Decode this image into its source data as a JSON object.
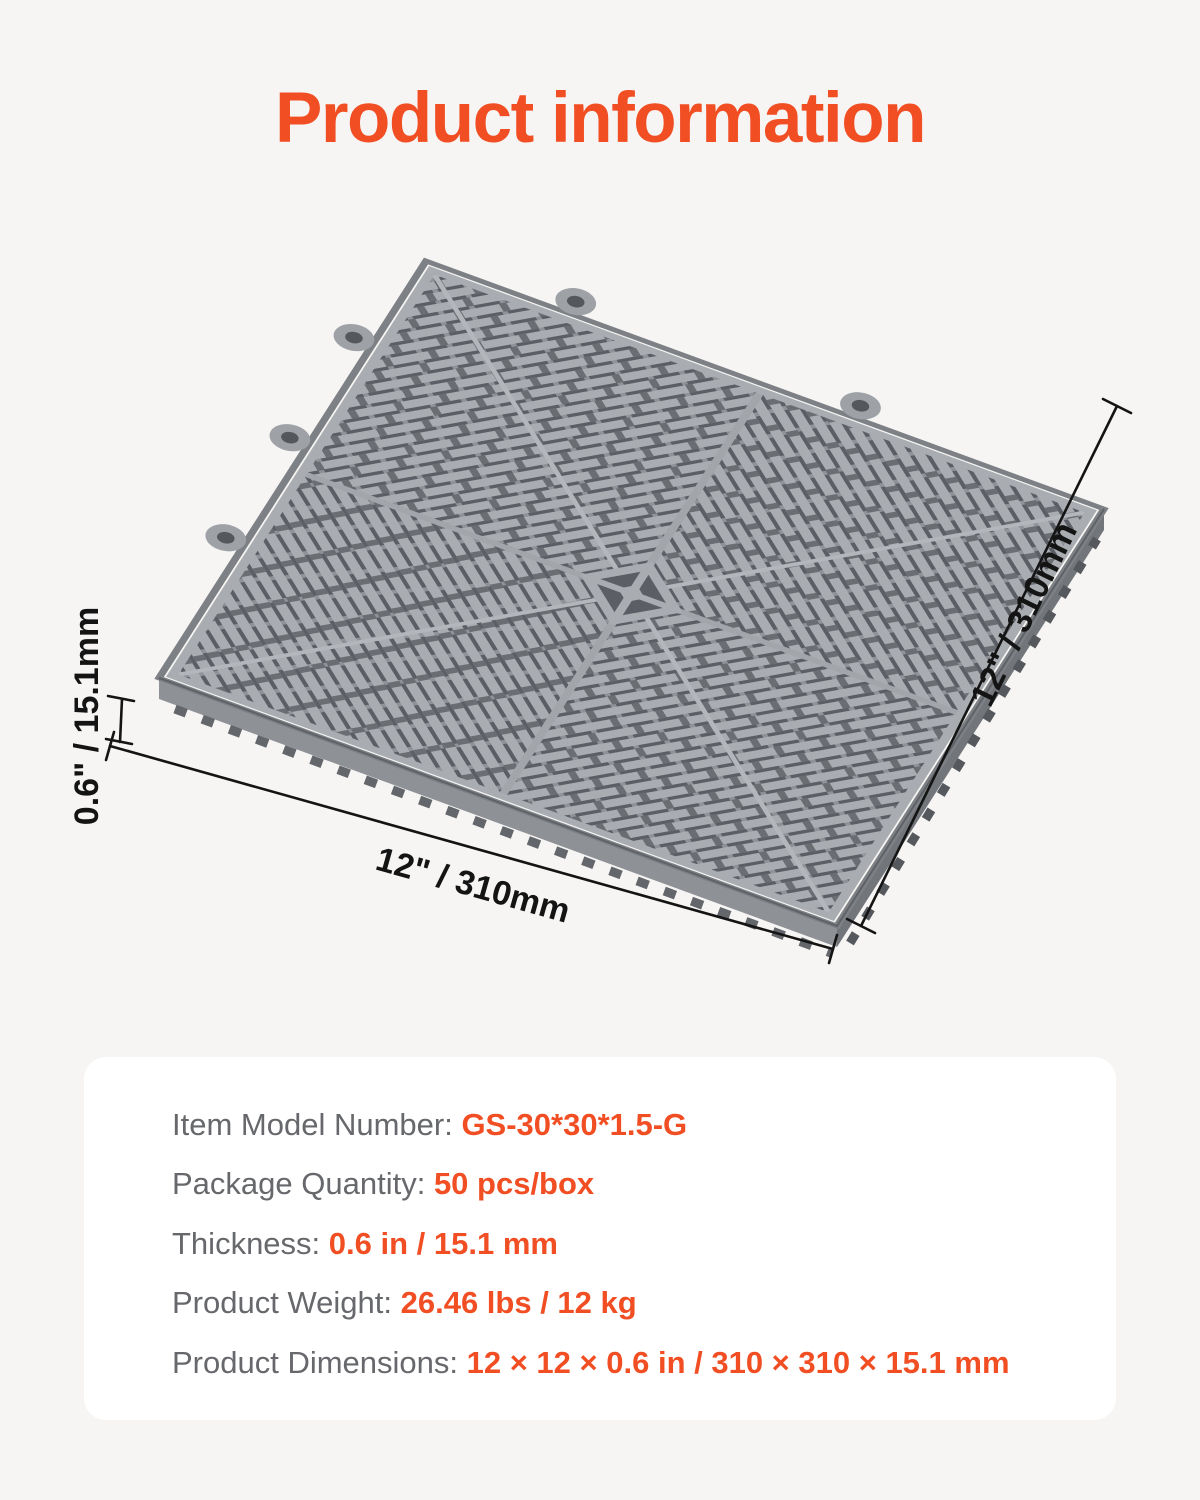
{
  "title": "Product information",
  "figure": {
    "dim_width_bottom": "12\" / 310mm",
    "dim_depth_right": "12\" / 310mm",
    "dim_thickness_left": "0.6\" / 15.1mm"
  },
  "specs": {
    "rows": [
      {
        "label": "Item Model Number: ",
        "value": "GS-30*30*1.5-G"
      },
      {
        "label": "Package Quantity: ",
        "value": "50 pcs/box"
      },
      {
        "label": "Thickness: ",
        "value": "0.6 in / 15.1 mm"
      },
      {
        "label": "Product Weight: ",
        "value": "26.46 lbs / 12 kg"
      },
      {
        "label": "Product Dimensions: ",
        "value": "12 × 12 × 0.6 in / 310 × 310 × 15.1 mm"
      }
    ]
  },
  "colors": {
    "accent": "#F14E23",
    "page_background": "#F6F5F3",
    "card_background": "#FFFFFF",
    "spec_label": "#66686B",
    "dimension_line": "#141414",
    "tile": {
      "rib": "#A9ACB1",
      "slot": "#6A6D72",
      "connector": "#8F9297",
      "base": "#5B5E64",
      "rim_outer": "#7D8085",
      "seam": "#B3B6BA",
      "spoke": "#A2A5AA",
      "side_light": "#8E9196",
      "side_dark": "#72757A",
      "teeth_left": "#63666B",
      "teeth_right": "#55585D",
      "loop": "#9EA1A6",
      "loop_hole": "#54575C"
    }
  }
}
